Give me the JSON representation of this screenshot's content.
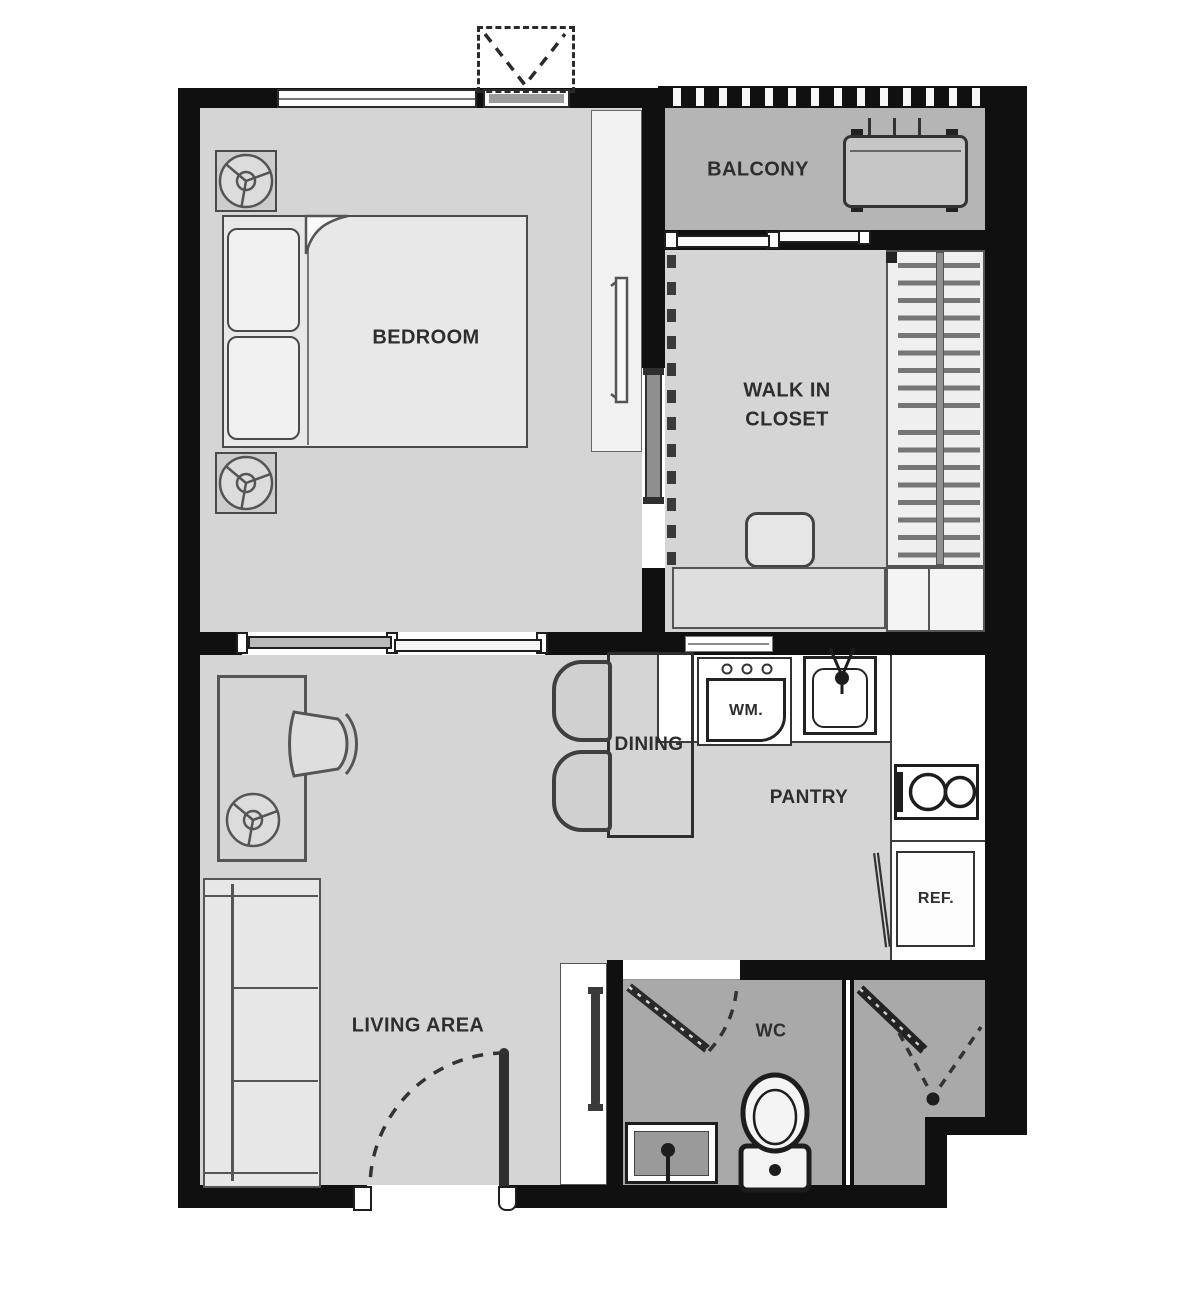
{
  "labels": {
    "bedroom": "BEDROOM",
    "balcony": "BALCONY",
    "walk_in_closet_line1": "WALK IN",
    "walk_in_closet_line2": "CLOSET",
    "dining": "DINING",
    "pantry": "PANTRY",
    "living_area": "LIVING AREA",
    "wc": "WC",
    "washing_machine": "WM.",
    "refrigerator": "REF."
  },
  "fixtures": [
    "double-bed",
    "pillows",
    "blanket-fold",
    "nightstand-lamp",
    "tv-panel",
    "window",
    "ac-outdoor-unit",
    "balcony-railing",
    "sliding-glass-door",
    "wardrobe-hangers",
    "closet-stool",
    "closet-dresser",
    "desk",
    "desk-chair",
    "table-lamp",
    "sofa",
    "dining-table",
    "dining-chairs",
    "washing-machine",
    "kitchen-sink",
    "faucet",
    "two-burner-stove",
    "refrigerator",
    "toilet",
    "wash-basin",
    "vanity",
    "entrance-door-swing",
    "wc-door-swing",
    "shower-door",
    "sliding-panel"
  ],
  "colors": {
    "wall": "#101010",
    "floor": "#d5d5d5",
    "balconyfloor": "#b5b5b5",
    "wetfloor": "#a9a9a9",
    "furniture": "#e8e8e8",
    "counter": "#ffffff",
    "outline": "#4a4a4a",
    "label": "#2e2e2e",
    "glass": "#b9b9b9"
  }
}
